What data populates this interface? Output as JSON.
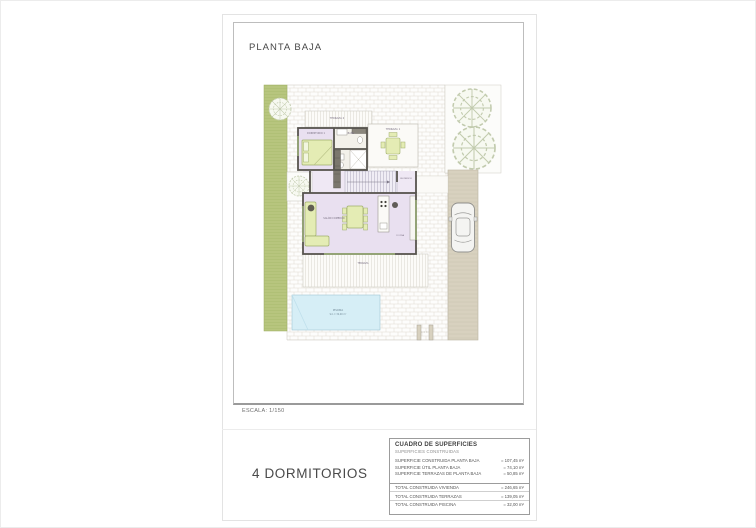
{
  "sheet": {
    "plan_title": "PLANTA BAJA",
    "scale_label": "ESCALA: 1/150",
    "bedrooms_caption": "4 DORMITORIOS"
  },
  "surfaces_table": {
    "title": "CUADRO DE SUPERFICIES",
    "subtitle": "SUPERFICIES CONSTRUIDAS",
    "rows": [
      {
        "label": "SUPERFICIE CONSTRUIDA PLANTA BAJA",
        "value": "= 107,45 m²"
      },
      {
        "label": "SUPERFICIE ÚTIL PLANTA BAJA",
        "value": "= 74,10 m²"
      },
      {
        "label": "SUPERFICIE TERRAZAS DE PLANTA BAJA",
        "value": "= 50,85 m²"
      }
    ],
    "totals": [
      {
        "label": "TOTAL CONSTRUIDA VIVIENDA",
        "value": "= 246,65 m²"
      },
      {
        "label": "TOTAL CONSTRUIDA TERRAZAS",
        "value": "= 139,05 m²"
      },
      {
        "label": "TOTAL CONSTRUIDA PISCINA",
        "value": "= 32,00 m²"
      }
    ]
  },
  "plan": {
    "labels": {
      "terraza2": "TERRAZA 2",
      "dormitorio1": "DORMITORIO 1",
      "bano": "BAÑO",
      "terraza1": "TERRAZA 1",
      "recibidor": "RECIBIDOR",
      "salon_comedor": "SALÓN COMEDOR",
      "cocina": "COCINA",
      "terraza_trasera": "TERRAZA",
      "piscina": "PISCINA",
      "piscina_area": "S.C.= 32,00 m²"
    },
    "colors": {
      "grass": "#b7c57e",
      "driveway": "#d8d1bf",
      "pool": "#d6eef6",
      "room_floor": "#e9e0f0",
      "hall_floor": "#efe8f4",
      "furniture": "#e4ecb4",
      "wall": "#57544e"
    }
  }
}
